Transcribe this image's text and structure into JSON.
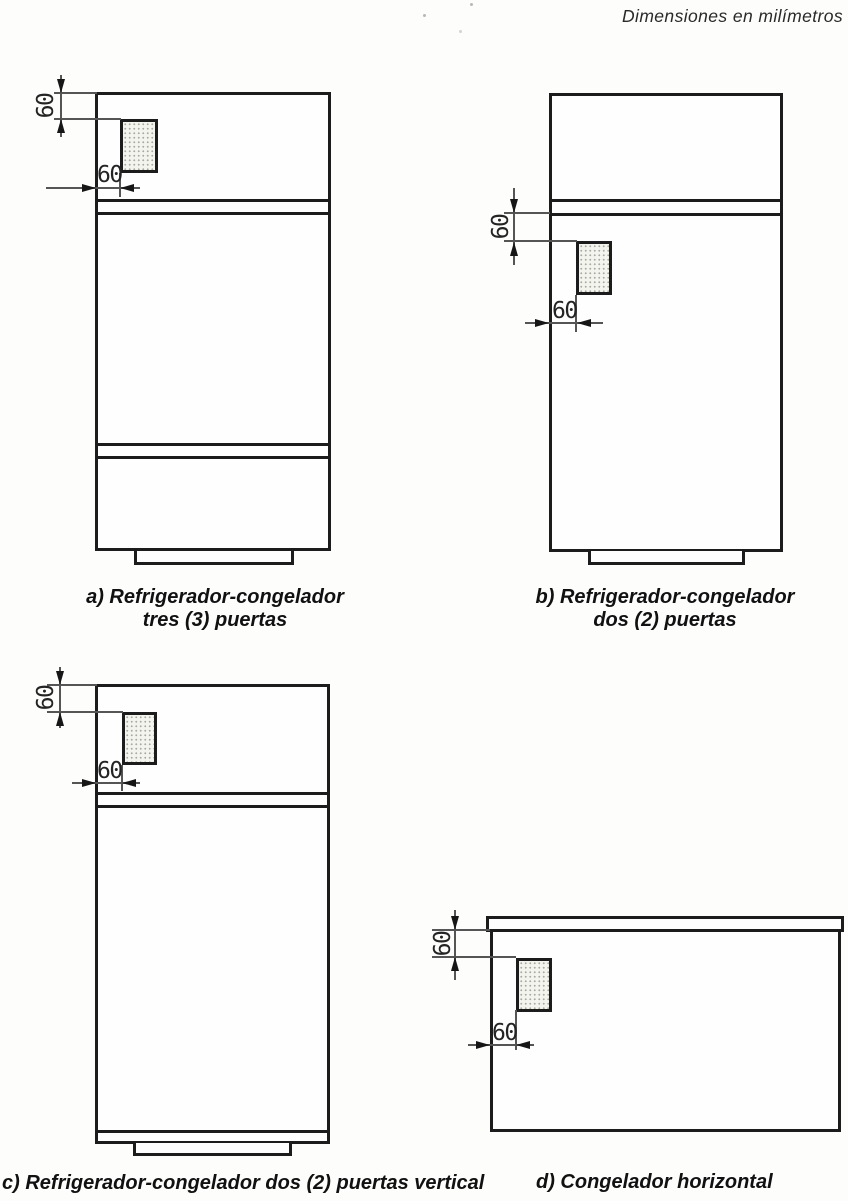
{
  "header": {
    "units_note": "Dimensiones en milímetros"
  },
  "colors": {
    "ink": "#1c1c1c",
    "paper": "#fdfdfc",
    "plate_fill": "#f4f4ef"
  },
  "figures": {
    "a": {
      "caption_line1": "a) Refrigerador-congelador",
      "caption_line2": "tres (3) puertas",
      "top_offset_mm": "60",
      "side_offset_mm": "60"
    },
    "b": {
      "caption_line1": "b) Refrigerador-congelador",
      "caption_line2": "dos (2) puertas",
      "top_offset_mm": "60",
      "side_offset_mm": "60"
    },
    "c": {
      "caption": "c) Refrigerador-congelador dos (2) puertas vertical",
      "top_offset_mm": "60",
      "side_offset_mm": "60"
    },
    "d": {
      "caption": "d) Congelador horizontal",
      "top_offset_mm": "60",
      "side_offset_mm": "60"
    }
  }
}
